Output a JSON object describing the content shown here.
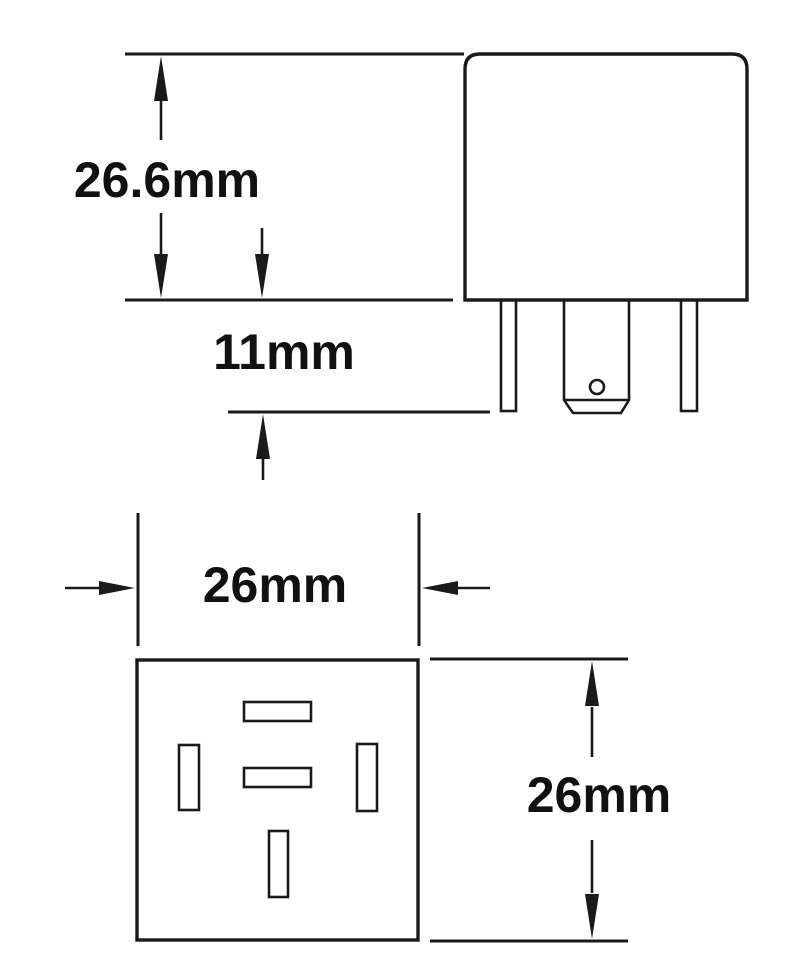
{
  "colors": {
    "line": "#1a1a1a",
    "text": "#111111",
    "background": "#ffffff"
  },
  "diagram": {
    "side_view": {
      "body_height_label": "26.6mm",
      "pin_length_label": "11mm"
    },
    "bottom_view": {
      "width_label": "26mm",
      "height_label": "26mm"
    }
  }
}
